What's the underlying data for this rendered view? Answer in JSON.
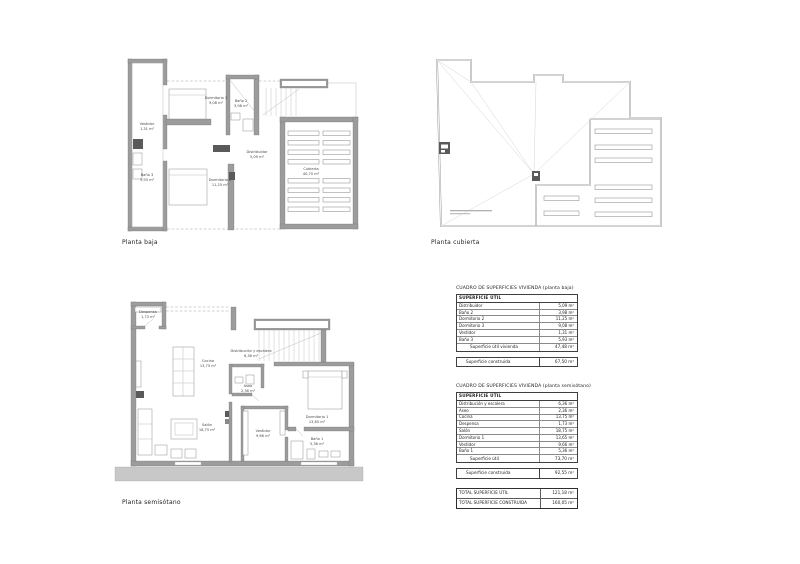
{
  "plans": {
    "baja": {
      "label": "Planta baja",
      "rooms": [
        {
          "name": "Vestidor",
          "area": "1,31 m²"
        },
        {
          "name": "Baño 3",
          "area": "5,93 m²"
        },
        {
          "name": "Dormitorio 3",
          "area": "9,08 m²"
        },
        {
          "name": "Baño 2",
          "area": "3,98 m²"
        },
        {
          "name": "Distribuidor",
          "area": "5,09 m²"
        },
        {
          "name": "Dormitorio 2",
          "area": "11,25 m²"
        },
        {
          "name": "Cubierta",
          "area": "40,70 m²"
        }
      ]
    },
    "cubierta": {
      "label": "Planta cubierta"
    },
    "semisotano": {
      "label": "Planta semisótano",
      "rooms": [
        {
          "name": "Despensa",
          "area": "1,73 m²"
        },
        {
          "name": "Cocina",
          "area": "13,75 m²"
        },
        {
          "name": "Distribución y escalera",
          "area": "6,36 m²"
        },
        {
          "name": "Aseo",
          "area": "2,36 m²"
        },
        {
          "name": "Salón",
          "area": "18,75 m²"
        },
        {
          "name": "Vestidor",
          "area": "9,66 m²"
        },
        {
          "name": "Dormitorio 1",
          "area": "13,65 m²"
        },
        {
          "name": "Baño 1",
          "area": "5,36 m²"
        }
      ]
    }
  },
  "tables": [
    {
      "title": "CUADRO DE SUPERFICIES VIVIENDA (planta baja)",
      "header": "SUPERFICIE  ÚTIL",
      "rows": [
        {
          "label": "Distribuidor",
          "value": "5,09 m²"
        },
        {
          "label": "Baño 2",
          "value": "3,98 m²"
        },
        {
          "label": "Dormitorio 2",
          "value": "11,25 m²"
        },
        {
          "label": "Dormitorio 3",
          "value": "9,08 m²"
        },
        {
          "label": "Vestidor",
          "value": "1,31 m²"
        },
        {
          "label": "Baño 3",
          "value": "5,93 m²"
        }
      ],
      "total_label": "Superficie útil vivienda",
      "total_value": "47,48 m²",
      "construida_label": "Superficie construida",
      "construida_value": "67,50 m²"
    },
    {
      "title": "CUADRO DE SUPERFICIES VIVIENDA (planta semisótano)",
      "header": "SUPERFICIE  ÚTIL",
      "rows": [
        {
          "label": "Distribución y escalera",
          "value": "6,36 m²"
        },
        {
          "label": "Aseo",
          "value": "2,36 m²"
        },
        {
          "label": "Cocina",
          "value": "13,75 m²"
        },
        {
          "label": "Despensa",
          "value": "1,73 m²"
        },
        {
          "label": "Salón",
          "value": "18,75 m²"
        },
        {
          "label": "Dormitorio 1",
          "value": "13,65 m²"
        },
        {
          "label": "Vestidor",
          "value": "9,66 m²"
        },
        {
          "label": "Baño 1",
          "value": "5,36 m²"
        }
      ],
      "total_label": "Superficie útil",
      "total_value": "73,70 m²",
      "construida_label": "Superficie construida",
      "construida_value": "92,55 m²"
    }
  ],
  "totals": {
    "rows": [
      {
        "label": "TOTAL SUPERFICIE  ÚTIL",
        "value": "121,18 m²"
      },
      {
        "label": "TOTAL SUPERFICIE  CONSTRUIDA",
        "value": "160,05 m²"
      }
    ]
  }
}
